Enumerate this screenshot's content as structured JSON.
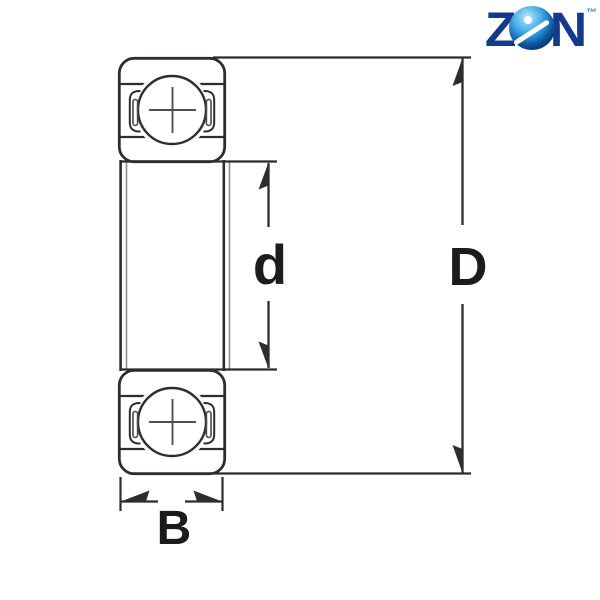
{
  "logo": {
    "letter_z": "Z",
    "letter_n": "N",
    "trademark": "™",
    "navy_color": "#143a8a",
    "ball_blue_color": "#1f8ad2",
    "trademark_color": "#2a8fd4"
  },
  "diagram": {
    "type": "bearing-cross-section-dimension-drawing",
    "line_color": "#2e2c2d",
    "thin_line_color": "#8f8f8f",
    "dimension_labels": {
      "bore_diameter": "d",
      "outer_diameter": "D",
      "width": "B"
    }
  }
}
